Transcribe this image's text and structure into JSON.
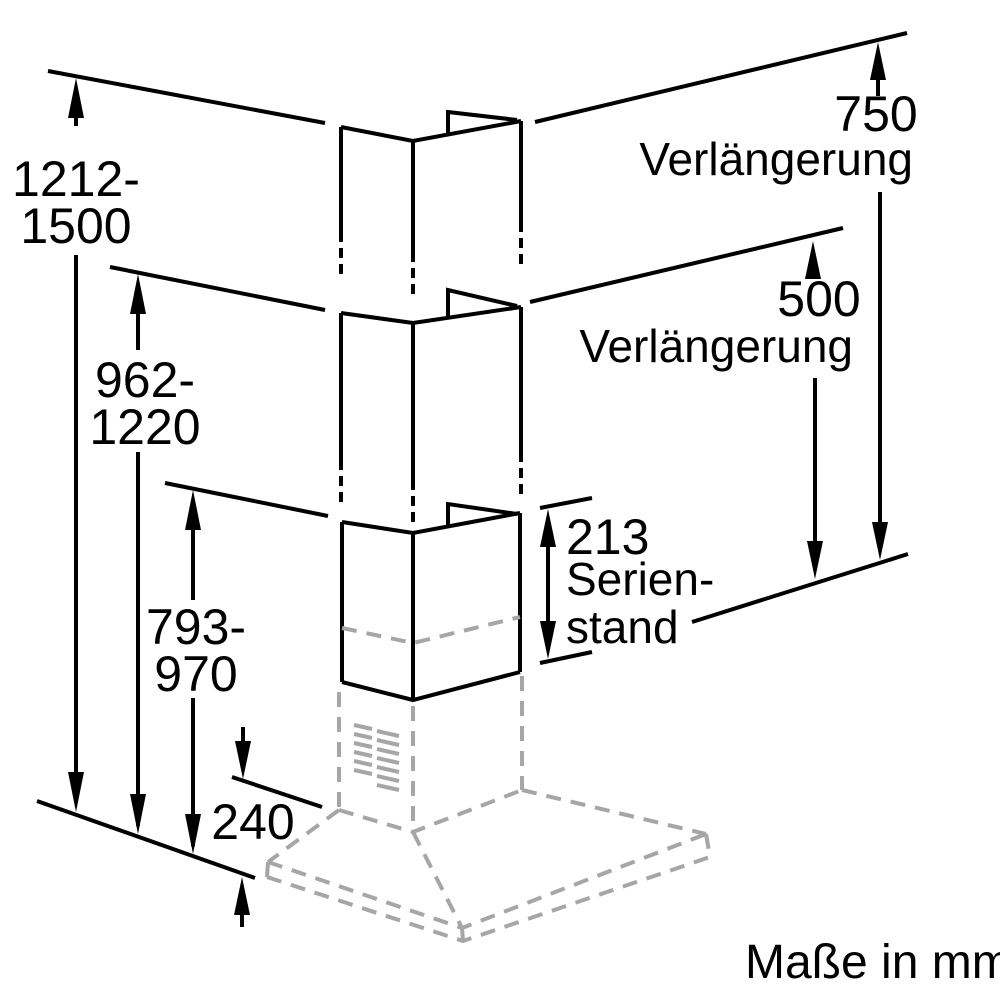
{
  "drawing": {
    "units_note": "Maße in mm",
    "colors": {
      "line": "#000000",
      "hidden_line": "#a6a6a6",
      "background": "#ffffff"
    },
    "dimensions": {
      "total_height_ext750": {
        "line1": "1212-",
        "line2": "1500"
      },
      "total_height_ext500": {
        "line1": "962-",
        "line2": "1220"
      },
      "standard_height": {
        "line1": "793-",
        "line2": "970"
      },
      "hood_body_height": "240",
      "extension_750": {
        "value": "750",
        "label": "Verlängerung"
      },
      "extension_500": {
        "value": "500",
        "label": "Verlängerung"
      },
      "serienstand_213": {
        "value": "213",
        "label_line1": "Serien-",
        "label_line2": "stand"
      }
    }
  }
}
